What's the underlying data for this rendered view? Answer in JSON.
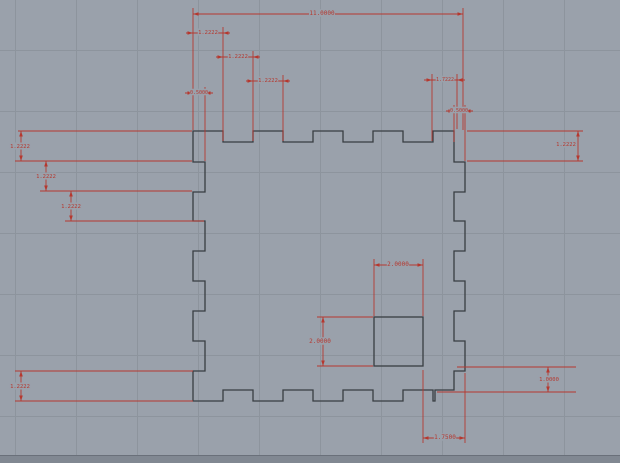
{
  "app": {
    "name": "cad-drawing-view",
    "canvas_width": 620,
    "canvas_height": 463,
    "background_color": "#9aa1ab",
    "grid_color": "#8d949d",
    "outline_color": "#383d42",
    "dimension_color": "#b5382f",
    "edge_strip_color": "#818892",
    "edge_line_color": "#6a707a"
  },
  "grid": {
    "spacing": 61,
    "x_lines": [
      15,
      76,
      137,
      198,
      259,
      320,
      381,
      442,
      503,
      564
    ],
    "y_lines": [
      50,
      111,
      172,
      233,
      294,
      355,
      416
    ]
  },
  "drawing": {
    "description": "finger-jointed box side panel, 11 x 11 units, 9 tabs of 1.2222 per edge, 0.5 tab depth, 2 x 2 square hole",
    "part": {
      "path": "M193,131 H223 V142 H253 V131 H283 V142 H313 V131 H343 V142 H373 V131 H403 V142 H433 V131 H454 V162 H465 V192 H454 V221 H465 V251 H454 V281 H465 V311 H454 V341 H465 V371 H454 V390 H435 V401 H433 V390 H403 V401 H373 V390 H343 V401 H313 V390 H283 V401 H253 V390 H223 V401 H193 V371 H205 V341 H193 V311 H205 V281 H193 V251 H205 V221 H193 V192 H205 V162 H193 Z",
      "hole": {
        "x": 374,
        "y": 317,
        "w": 49,
        "h": 49,
        "width_units": "2.0000",
        "height_units": "2.0000"
      }
    },
    "dimensions": [
      {
        "label": "11.0000",
        "size": 6,
        "lx": 322,
        "ly": 13,
        "lines": [
          [
            193,
            14,
            463,
            14
          ],
          [
            193,
            8,
            193,
            130
          ],
          [
            463,
            8,
            463,
            130
          ]
        ],
        "arrows": [
          [
            193,
            14,
            "left"
          ],
          [
            463,
            14,
            "right"
          ]
        ]
      },
      {
        "label": "1.2222",
        "size": 5.5,
        "lx": 208,
        "ly": 32,
        "lines": [
          [
            186,
            33,
            230,
            33
          ],
          [
            223,
            27,
            223,
            141
          ]
        ],
        "arrows": [
          [
            193,
            33,
            "right"
          ],
          [
            223,
            33,
            "left"
          ]
        ]
      },
      {
        "label": "1.2222",
        "size": 5.5,
        "lx": 238,
        "ly": 56,
        "lines": [
          [
            216,
            57,
            260,
            57
          ],
          [
            253,
            51,
            253,
            141
          ]
        ],
        "arrows": [
          [
            223,
            57,
            "right"
          ],
          [
            253,
            57,
            "left"
          ]
        ]
      },
      {
        "label": "1.2222",
        "size": 5.5,
        "lx": 268,
        "ly": 80,
        "lines": [
          [
            246,
            81,
            290,
            81
          ],
          [
            283,
            75,
            283,
            141
          ]
        ],
        "arrows": [
          [
            253,
            81,
            "right"
          ],
          [
            283,
            81,
            "left"
          ]
        ]
      },
      {
        "label": "0.5000",
        "size": 5,
        "lx": 199,
        "ly": 92,
        "lines": [
          [
            185,
            93,
            213,
            93
          ],
          [
            205,
            87,
            205,
            161
          ]
        ],
        "arrows": [
          [
            193,
            93,
            "right"
          ],
          [
            205,
            93,
            "left"
          ]
        ]
      },
      {
        "label": "1.7222",
        "size": 5,
        "lx": 445,
        "ly": 79,
        "lines": [
          [
            424,
            80,
            465,
            80
          ],
          [
            432,
            74,
            432,
            141
          ],
          [
            457,
            74,
            457,
            129
          ]
        ],
        "arrows": [
          [
            432,
            80,
            "right"
          ],
          [
            457,
            80,
            "left"
          ]
        ]
      },
      {
        "label": "0.5000",
        "size": 5,
        "lx": 459,
        "ly": 110,
        "lines": [
          [
            446,
            111,
            473,
            111
          ],
          [
            454,
            105,
            454,
            142
          ],
          [
            465,
            105,
            465,
            161
          ]
        ],
        "arrows": [
          [
            454,
            111,
            "right"
          ],
          [
            465,
            111,
            "left"
          ]
        ]
      },
      {
        "label": "1.2222",
        "size": 5.5,
        "lx": 566,
        "ly": 144,
        "lines": [
          [
            467,
            131,
            583,
            131
          ],
          [
            467,
            161,
            583,
            161
          ],
          [
            578,
            131,
            578,
            161
          ]
        ],
        "arrows": [
          [
            578,
            131,
            "up"
          ],
          [
            578,
            161,
            "down"
          ]
        ]
      },
      {
        "label": "1.2222",
        "size": 5.5,
        "lx": 20,
        "ly": 146,
        "lines": [
          [
            18,
            131,
            192,
            131
          ],
          [
            15,
            161,
            192,
            161
          ],
          [
            21,
            131,
            21,
            161
          ]
        ],
        "arrows": [
          [
            21,
            131,
            "up"
          ],
          [
            21,
            161,
            "down"
          ]
        ]
      },
      {
        "label": "1.2222",
        "size": 5.5,
        "lx": 46,
        "ly": 176,
        "lines": [
          [
            40,
            191,
            192,
            191
          ],
          [
            46,
            161,
            46,
            191
          ]
        ],
        "arrows": [
          [
            46,
            161,
            "up"
          ],
          [
            46,
            191,
            "down"
          ]
        ]
      },
      {
        "label": "1.2222",
        "size": 5.5,
        "lx": 71,
        "ly": 206,
        "lines": [
          [
            65,
            221,
            204,
            221
          ],
          [
            71,
            191,
            71,
            221
          ]
        ],
        "arrows": [
          [
            71,
            191,
            "up"
          ],
          [
            71,
            221,
            "down"
          ]
        ]
      },
      {
        "label": "1.2222",
        "size": 5.5,
        "lx": 20,
        "ly": 386,
        "lines": [
          [
            15,
            371,
            193,
            371
          ],
          [
            15,
            401,
            193,
            401
          ],
          [
            21,
            371,
            21,
            401
          ]
        ],
        "arrows": [
          [
            21,
            371,
            "up"
          ],
          [
            21,
            401,
            "down"
          ]
        ]
      },
      {
        "label": "1.0000",
        "size": 5.5,
        "lx": 549,
        "ly": 379,
        "lines": [
          [
            457,
            367,
            576,
            367
          ],
          [
            437,
            392,
            576,
            392
          ],
          [
            548,
            367,
            548,
            392
          ]
        ],
        "arrows": [
          [
            548,
            367,
            "up"
          ],
          [
            548,
            392,
            "down"
          ]
        ]
      },
      {
        "label": "2.0000",
        "size": 6,
        "lx": 398,
        "ly": 264,
        "lines": [
          [
            374,
            265,
            423,
            265
          ],
          [
            374,
            259,
            374,
            316
          ],
          [
            423,
            259,
            423,
            316
          ]
        ],
        "arrows": [
          [
            374,
            265,
            "left"
          ],
          [
            423,
            265,
            "right"
          ]
        ]
      },
      {
        "label": "2.0000",
        "size": 6,
        "lx": 320,
        "ly": 341,
        "lines": [
          [
            323,
            317,
            323,
            366
          ],
          [
            317,
            317,
            373,
            317
          ],
          [
            317,
            366,
            373,
            366
          ]
        ],
        "arrows": [
          [
            323,
            317,
            "up"
          ],
          [
            323,
            366,
            "down"
          ]
        ]
      },
      {
        "label": "1.7500",
        "size": 6,
        "lx": 445,
        "ly": 437,
        "lines": [
          [
            423,
            438,
            465,
            438
          ],
          [
            423,
            370,
            423,
            443
          ],
          [
            465,
            373,
            465,
            443
          ]
        ],
        "arrows": [
          [
            423,
            438,
            "left"
          ],
          [
            465,
            438,
            "right"
          ]
        ]
      }
    ]
  }
}
